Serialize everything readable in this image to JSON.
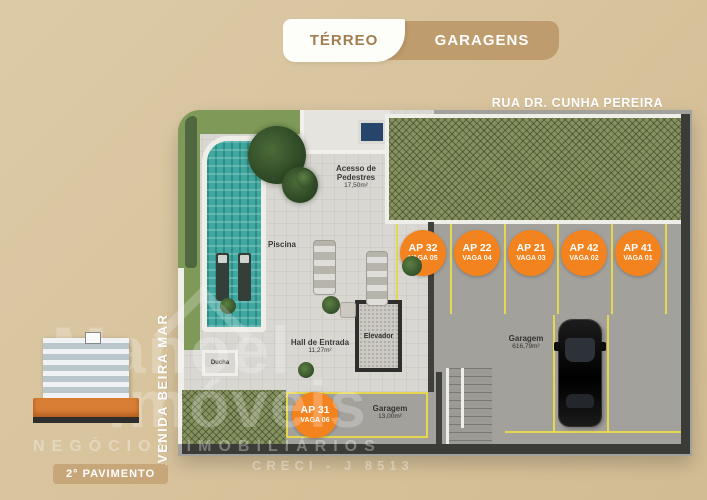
{
  "tabs": {
    "terreo": "TÉRREO",
    "garagens": "GARAGENS"
  },
  "streets": {
    "top": "RUA DR. CUNHA PEREIRA",
    "left": "AVENIDA BEIRA MAR"
  },
  "plan": {
    "rooms": {
      "acesso": {
        "name": "Acesso de Pedestres",
        "area": "17,50m²"
      },
      "piscina": {
        "name": "Piscina"
      },
      "ducha": {
        "name": "Ducha"
      },
      "hall": {
        "name": "Hall de Entrada",
        "area": "11,27m²"
      },
      "elevador": {
        "name": "Elevador"
      },
      "garagem_principal": {
        "name": "Garagem",
        "area": "616,79m²"
      },
      "garagem_pequena": {
        "name": "Garagem",
        "area": "13,00m²"
      }
    },
    "vagas": [
      {
        "ap": "AP 32",
        "vaga": "VAGA 05"
      },
      {
        "ap": "AP 22",
        "vaga": "VAGA 04"
      },
      {
        "ap": "AP 21",
        "vaga": "VAGA 03"
      },
      {
        "ap": "AP 42",
        "vaga": "VAGA 02"
      },
      {
        "ap": "AP 41",
        "vaga": "VAGA 01"
      },
      {
        "ap": "AP 31",
        "vaga": "VAGA 06"
      }
    ]
  },
  "watermark": {
    "brand_line1": "Manoel",
    "brand_line2": "Imóveis",
    "subtitle": "NEGÓCIOS IMOBILIÁRIOS",
    "creci": "CRECI - J 8513"
  },
  "thumbnail": {
    "label": "2° PAVIMENTO"
  },
  "colors": {
    "background": "#d7c29b",
    "tabbar": "#bf9c6d",
    "active_tab_text": "#a17d50",
    "orange_badge": "#f2831f",
    "parking_line": "#e5d74f",
    "pool": "#3fa8a0",
    "hedge": "#87915f",
    "garage_floor": "#a3a19c"
  }
}
